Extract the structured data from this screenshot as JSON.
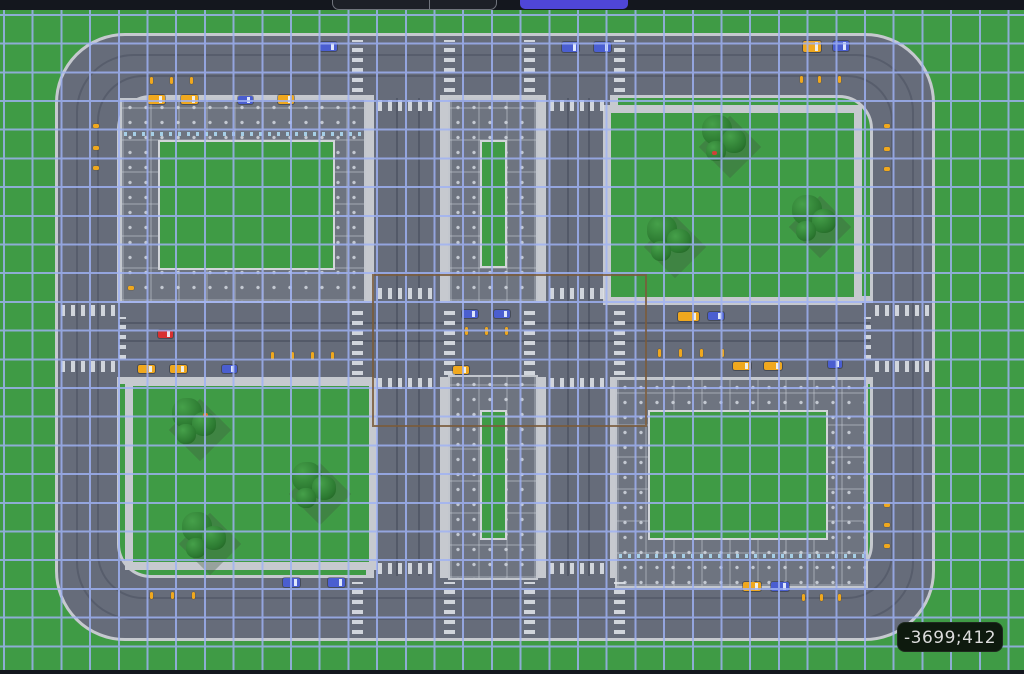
{
  "hud": {
    "coordinate_readout": "-3699;412"
  },
  "topbar": {
    "address_pill_value": "",
    "primary_button_label": ""
  },
  "colors": {
    "grass": "#3f9b45",
    "grid_line": "#9fb2f4",
    "road": "#666c7a",
    "sidewalk": "#c6c9cf",
    "building": "#6e7480",
    "courtyard_border": "#d2d5da",
    "selection": "#7a5c3c",
    "vehicle_yellow": "#f0a81e",
    "vehicle_blue": "#4a5ed0",
    "vehicle_red": "#d93030",
    "topbar_bg": "#14171e",
    "accent_purple": "#4f46d8",
    "coord_bg": "#0e1a0e",
    "coord_text": "#dcdcdc"
  },
  "map": {
    "grid": {
      "spacing": 28.7
    },
    "vehicles": [
      {
        "x": 320,
        "y": 32,
        "w": 17,
        "h": 9,
        "color": "blue",
        "type": "car"
      },
      {
        "x": 562,
        "y": 32,
        "w": 17,
        "h": 10,
        "color": "blue",
        "type": "truck"
      },
      {
        "x": 594,
        "y": 32,
        "w": 17,
        "h": 10,
        "color": "blue",
        "type": "truck"
      },
      {
        "x": 803,
        "y": 31,
        "w": 18,
        "h": 11,
        "color": "yellow",
        "type": "car"
      },
      {
        "x": 833,
        "y": 31,
        "w": 16,
        "h": 10,
        "color": "blue",
        "type": "truck"
      },
      {
        "x": 148,
        "y": 85,
        "w": 17,
        "h": 9,
        "color": "yellow",
        "type": "taxi"
      },
      {
        "x": 181,
        "y": 85,
        "w": 17,
        "h": 9,
        "color": "yellow",
        "type": "taxi"
      },
      {
        "x": 238,
        "y": 86,
        "w": 15,
        "h": 8,
        "color": "blue",
        "type": "car"
      },
      {
        "x": 278,
        "y": 85,
        "w": 16,
        "h": 9,
        "color": "yellow",
        "type": "taxi"
      },
      {
        "x": 158,
        "y": 320,
        "w": 15,
        "h": 8,
        "color": "red",
        "type": "car"
      },
      {
        "x": 138,
        "y": 355,
        "w": 17,
        "h": 8,
        "color": "yellow",
        "type": "taxi"
      },
      {
        "x": 170,
        "y": 355,
        "w": 17,
        "h": 8,
        "color": "yellow",
        "type": "taxi"
      },
      {
        "x": 222,
        "y": 355,
        "w": 15,
        "h": 8,
        "color": "blue",
        "type": "car"
      },
      {
        "x": 462,
        "y": 300,
        "w": 16,
        "h": 8,
        "color": "blue",
        "type": "car"
      },
      {
        "x": 494,
        "y": 300,
        "w": 16,
        "h": 8,
        "color": "blue",
        "type": "car"
      },
      {
        "x": 453,
        "y": 356,
        "w": 16,
        "h": 8,
        "color": "yellow",
        "type": "taxi"
      },
      {
        "x": 678,
        "y": 302,
        "w": 21,
        "h": 9,
        "color": "yellow",
        "type": "bus"
      },
      {
        "x": 708,
        "y": 302,
        "w": 16,
        "h": 8,
        "color": "blue",
        "type": "car"
      },
      {
        "x": 733,
        "y": 352,
        "w": 18,
        "h": 8,
        "color": "yellow",
        "type": "taxi"
      },
      {
        "x": 764,
        "y": 352,
        "w": 18,
        "h": 8,
        "color": "yellow",
        "type": "taxi"
      },
      {
        "x": 828,
        "y": 350,
        "w": 14,
        "h": 8,
        "color": "blue",
        "type": "car"
      },
      {
        "x": 283,
        "y": 568,
        "w": 17,
        "h": 9,
        "color": "blue",
        "type": "car"
      },
      {
        "x": 328,
        "y": 568,
        "w": 17,
        "h": 9,
        "color": "blue",
        "type": "car"
      },
      {
        "x": 743,
        "y": 572,
        "w": 18,
        "h": 9,
        "color": "yellow",
        "type": "taxi"
      },
      {
        "x": 771,
        "y": 572,
        "w": 18,
        "h": 9,
        "color": "blue",
        "type": "car"
      }
    ],
    "ticks": [
      {
        "x": 150,
        "y": 67,
        "w": 3,
        "h": 7
      },
      {
        "x": 170,
        "y": 67,
        "w": 3,
        "h": 7
      },
      {
        "x": 190,
        "y": 67,
        "w": 3,
        "h": 7
      },
      {
        "x": 800,
        "y": 66,
        "w": 3,
        "h": 7
      },
      {
        "x": 818,
        "y": 66,
        "w": 3,
        "h": 7
      },
      {
        "x": 838,
        "y": 66,
        "w": 3,
        "h": 7
      },
      {
        "x": 93,
        "y": 114,
        "w": 6,
        "h": 4
      },
      {
        "x": 93,
        "y": 136,
        "w": 6,
        "h": 4
      },
      {
        "x": 93,
        "y": 156,
        "w": 6,
        "h": 4
      },
      {
        "x": 128,
        "y": 276,
        "w": 6,
        "h": 4
      },
      {
        "x": 884,
        "y": 114,
        "w": 6,
        "h": 4
      },
      {
        "x": 884,
        "y": 137,
        "w": 6,
        "h": 4
      },
      {
        "x": 884,
        "y": 157,
        "w": 6,
        "h": 4
      },
      {
        "x": 884,
        "y": 493,
        "w": 6,
        "h": 4
      },
      {
        "x": 884,
        "y": 513,
        "w": 6,
        "h": 4
      },
      {
        "x": 884,
        "y": 534,
        "w": 6,
        "h": 4
      },
      {
        "x": 271,
        "y": 342,
        "w": 3,
        "h": 8
      },
      {
        "x": 291,
        "y": 342,
        "w": 3,
        "h": 8
      },
      {
        "x": 311,
        "y": 342,
        "w": 3,
        "h": 8
      },
      {
        "x": 331,
        "y": 342,
        "w": 3,
        "h": 8
      },
      {
        "x": 465,
        "y": 317,
        "w": 3,
        "h": 8
      },
      {
        "x": 485,
        "y": 317,
        "w": 3,
        "h": 8
      },
      {
        "x": 505,
        "y": 317,
        "w": 3,
        "h": 8
      },
      {
        "x": 658,
        "y": 339,
        "w": 3,
        "h": 8
      },
      {
        "x": 679,
        "y": 339,
        "w": 3,
        "h": 8
      },
      {
        "x": 700,
        "y": 339,
        "w": 3,
        "h": 8
      },
      {
        "x": 721,
        "y": 339,
        "w": 3,
        "h": 8
      },
      {
        "x": 150,
        "y": 582,
        "w": 3,
        "h": 7
      },
      {
        "x": 171,
        "y": 582,
        "w": 3,
        "h": 7
      },
      {
        "x": 192,
        "y": 582,
        "w": 3,
        "h": 7
      },
      {
        "x": 802,
        "y": 584,
        "w": 3,
        "h": 7
      },
      {
        "x": 820,
        "y": 584,
        "w": 3,
        "h": 7
      },
      {
        "x": 838,
        "y": 584,
        "w": 3,
        "h": 7
      }
    ],
    "trees": [
      {
        "x": 700,
        "y": 105
      },
      {
        "x": 790,
        "y": 185
      },
      {
        "x": 645,
        "y": 205
      },
      {
        "x": 170,
        "y": 388
      },
      {
        "x": 290,
        "y": 452
      },
      {
        "x": 180,
        "y": 502
      }
    ],
    "dots": [
      {
        "x": 203,
        "y": 403,
        "color": "#e07820"
      },
      {
        "x": 712,
        "y": 141,
        "color": "#d04038"
      }
    ],
    "crosswalks": [
      {
        "x": 61,
        "y": 295,
        "w": 54,
        "h": 11,
        "dir": "h"
      },
      {
        "x": 61,
        "y": 351,
        "w": 54,
        "h": 11,
        "dir": "h"
      },
      {
        "x": 119,
        "y": 307,
        "w": 7,
        "h": 42,
        "dir": "v"
      },
      {
        "x": 352,
        "y": 295,
        "w": 11,
        "h": 70,
        "dir": "v"
      },
      {
        "x": 444,
        "y": 295,
        "w": 11,
        "h": 70,
        "dir": "v"
      },
      {
        "x": 378,
        "y": 278,
        "w": 58,
        "h": 11,
        "dir": "h"
      },
      {
        "x": 378,
        "y": 368,
        "w": 58,
        "h": 11,
        "dir": "h"
      },
      {
        "x": 524,
        "y": 295,
        "w": 11,
        "h": 70,
        "dir": "v"
      },
      {
        "x": 614,
        "y": 295,
        "w": 11,
        "h": 70,
        "dir": "v"
      },
      {
        "x": 550,
        "y": 278,
        "w": 56,
        "h": 11,
        "dir": "h"
      },
      {
        "x": 550,
        "y": 368,
        "w": 56,
        "h": 11,
        "dir": "h"
      },
      {
        "x": 875,
        "y": 295,
        "w": 54,
        "h": 11,
        "dir": "h"
      },
      {
        "x": 875,
        "y": 351,
        "w": 54,
        "h": 11,
        "dir": "h"
      },
      {
        "x": 864,
        "y": 307,
        "w": 7,
        "h": 42,
        "dir": "v"
      },
      {
        "x": 352,
        "y": 30,
        "w": 11,
        "h": 52,
        "dir": "v"
      },
      {
        "x": 444,
        "y": 30,
        "w": 11,
        "h": 52,
        "dir": "v"
      },
      {
        "x": 378,
        "y": 90,
        "w": 58,
        "h": 11,
        "dir": "h"
      },
      {
        "x": 524,
        "y": 30,
        "w": 11,
        "h": 52,
        "dir": "v"
      },
      {
        "x": 614,
        "y": 30,
        "w": 11,
        "h": 52,
        "dir": "v"
      },
      {
        "x": 550,
        "y": 90,
        "w": 56,
        "h": 11,
        "dir": "h"
      },
      {
        "x": 352,
        "y": 572,
        "w": 11,
        "h": 52,
        "dir": "v"
      },
      {
        "x": 444,
        "y": 572,
        "w": 11,
        "h": 52,
        "dir": "v"
      },
      {
        "x": 378,
        "y": 553,
        "w": 58,
        "h": 11,
        "dir": "h"
      },
      {
        "x": 524,
        "y": 572,
        "w": 11,
        "h": 52,
        "dir": "v"
      },
      {
        "x": 614,
        "y": 572,
        "w": 11,
        "h": 52,
        "dir": "v"
      },
      {
        "x": 550,
        "y": 553,
        "w": 56,
        "h": 11,
        "dir": "h"
      }
    ]
  }
}
